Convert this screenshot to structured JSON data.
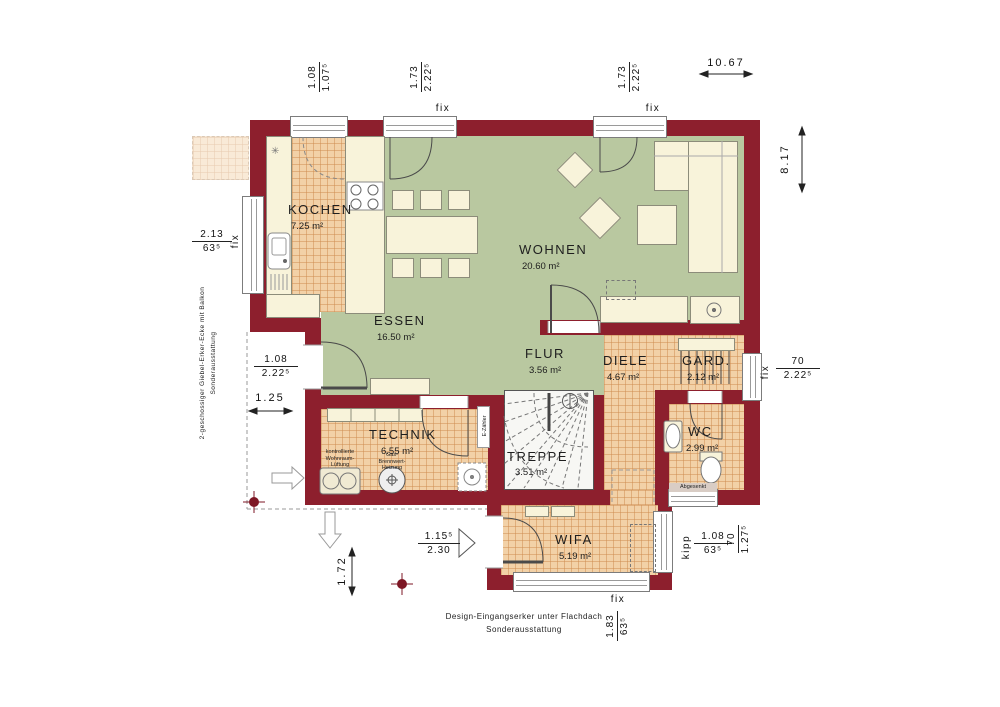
{
  "plan": {
    "rooms": {
      "kochen": {
        "name": "KOCHEN",
        "area": "7.25 m²"
      },
      "essen": {
        "name": "ESSEN",
        "area": "16.50 m²"
      },
      "wohnen": {
        "name": "WOHNEN",
        "area": "20.60 m²"
      },
      "flur": {
        "name": "FLUR",
        "area": "3.56 m²"
      },
      "diele": {
        "name": "DIELE",
        "area": "4.67 m²"
      },
      "gard": {
        "name": "GARD.",
        "area": "2.12 m²"
      },
      "technik": {
        "name": "TECHNIK",
        "area": "6.55 m²"
      },
      "treppe": {
        "name": "TREPPE",
        "area": "3.51 m²"
      },
      "wc": {
        "name": "WC",
        "area": "2.99 m²"
      },
      "wifa": {
        "name": "WIFA",
        "area": "5.19 m²"
      }
    },
    "windows": {
      "fix": "fix",
      "kipp": "kipp"
    },
    "dims": {
      "top1": {
        "a": "1.08",
        "b": "1.07⁵"
      },
      "top2": {
        "a": "1.73",
        "b": "2.22⁵"
      },
      "top3": {
        "a": "1.73",
        "b": "2.22⁵"
      },
      "total_width": "10.67",
      "total_height": "8.17",
      "left_window": {
        "a": "2.13",
        "b": "63⁵"
      },
      "left_door": {
        "a": "1.08",
        "b": "2.22⁵"
      },
      "left_offset": "1.25",
      "right_window": {
        "a": "70",
        "b": "2.22⁵"
      },
      "entry_door": {
        "a": "1.15⁵",
        "b": "2.30"
      },
      "porch_depth": "1.72",
      "porch_window": {
        "a": "1.83",
        "b": "63⁵"
      },
      "kipp_window": {
        "a": "1.08",
        "b": "63⁵"
      },
      "wc_window": {
        "a": "70",
        "b": "1.27⁵"
      }
    },
    "equipment": {
      "vent1": "kontrollierte",
      "vent2": "Wohnraum-",
      "vent3": "Lüftung",
      "heat1": "Gas-",
      "heat2": "Brennwert-",
      "heat3": "Heizung",
      "meter": "E-Zähler",
      "wc_wall": "Abgesenkt"
    },
    "notes": {
      "left1": "2-geschossiger Giebel-Erker-Ecke mit Balkon",
      "left2": "Sonderausstattung",
      "bottom1": "Design-Eingangserker unter Flachdach",
      "bottom2": "Sonderausstattung"
    },
    "icons": {
      "snowflake": "✳"
    },
    "colors": {
      "wall": "#8d1f2d",
      "floor_green": "#b9c8a0",
      "floor_tile": "#f2d1a7",
      "furniture": "#f8f3da"
    }
  }
}
